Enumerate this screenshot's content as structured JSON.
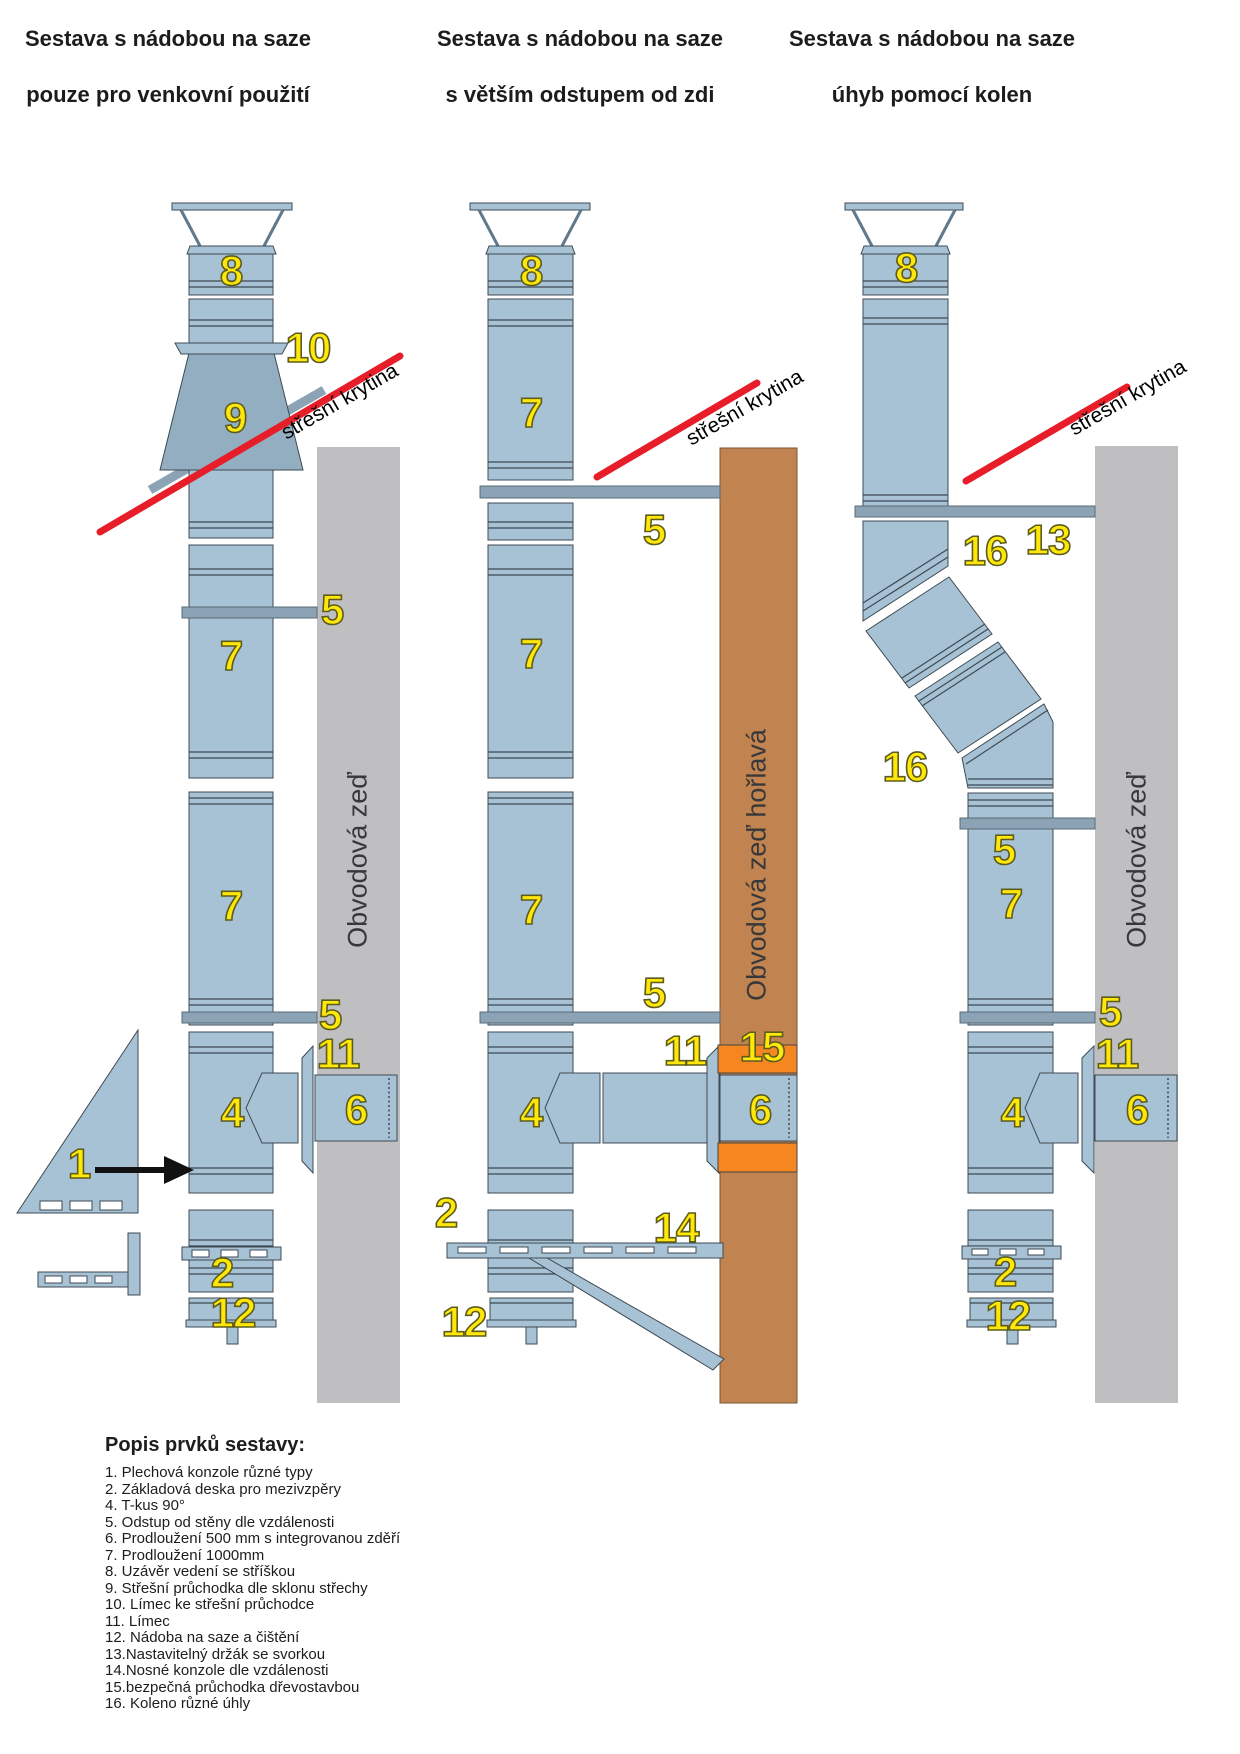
{
  "titles": [
    {
      "line1": "Sestava s nádobou na saze",
      "line2": "pouze pro venkovní použití"
    },
    {
      "line1": "Sestava s nádobou na saze",
      "line2": "s větším odstupem od zdi"
    },
    {
      "line1": "Sestava s nádobou na saze",
      "line2": "úhyb pomocí kolen"
    }
  ],
  "roof_label": "střešní krytina",
  "walls": {
    "outer": "Obvodová zeď",
    "flammable": "Obvodová zeď hořlavá"
  },
  "d1": {
    "n8": "8",
    "n10": "10",
    "n9": "9",
    "n5a": "5",
    "n7a": "7",
    "n7b": "7",
    "n5b": "5",
    "n11": "11",
    "n4": "4",
    "n6": "6",
    "n1": "1",
    "n2": "2",
    "n12": "12"
  },
  "d2": {
    "n8": "8",
    "n7a": "7",
    "n5a": "5",
    "n7b": "7",
    "n7c": "7",
    "n5b": "5",
    "n11": "11",
    "n15": "15",
    "n4": "4",
    "n6": "6",
    "n2": "2",
    "n14": "14",
    "n12": "12"
  },
  "d3": {
    "n8": "8",
    "n16a": "16",
    "n13": "13",
    "n16b": "16",
    "n7": "7",
    "n5a": "5",
    "n5b": "5",
    "n11": "11",
    "n4": "4",
    "n6": "6",
    "n2": "2",
    "n12": "12"
  },
  "legend": {
    "title": "Popis prvků sestavy:",
    "items": [
      "1.  Plechová konzole různé typy",
      "2.  Základová deska pro mezivzpěry",
      "4.  T-kus 90°",
      "5.  Odstup od stěny dle vzdálenosti",
      "6.  Prodloužení 500 mm s integrovanou zděří",
      "7.  Prodloužení 1000mm",
      "8.  Uzávěr vedení se stříškou",
      "9.  Střešní průchodka dle sklonu střechy",
      "10. Límec ke střešní průchodce",
      "11. Límec",
      "12. Nádoba na saze a čištění",
      "13.Nastavitelný držák se svorkou",
      "14.Nosné konzole dle vzdálenosti",
      "15.bezpečná průchodka dřevostavbou",
      "16. Koleno různé úhly"
    ]
  },
  "palette": {
    "pipe": "#a7c2d4",
    "pipe-dark": "#3d4a54",
    "cone": "#92aec0",
    "bar": "#8ba3b5",
    "wall-gray": "#bfbfc1",
    "wall-brown": "#c1834f",
    "orange": "#f6861f",
    "red": "#e71d29",
    "yellow": "#ffe70a",
    "yellow-outline": "#5c5c1e",
    "ink": "#1c1c1e"
  }
}
